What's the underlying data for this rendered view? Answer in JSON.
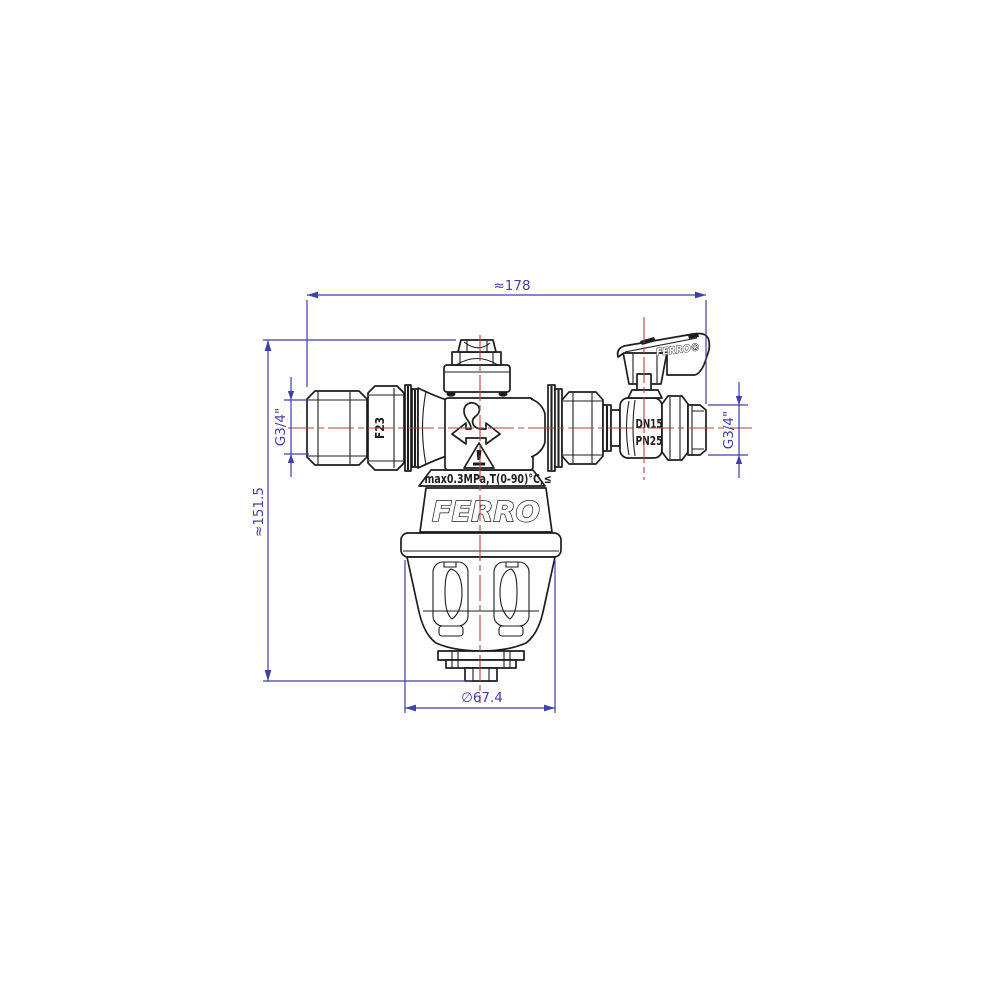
{
  "drawing": {
    "title": "FERRO magnetic filter with ball valve - technical drawing",
    "colors": {
      "background": "#ffffff",
      "outline": "#1d1d1d",
      "dimension": "#3f3fa8",
      "centerline": "#b6423c"
    },
    "dimensions": {
      "overall_width": "≈178",
      "overall_height": "≈151.5",
      "inlet_thread": "G3/4\"",
      "outlet_thread": "G3/4\"",
      "bowl_diameter": "∅67.4"
    },
    "markings": {
      "union_nut": "F23",
      "valve_size": "DN15",
      "valve_pressure": "PN25",
      "body_spec": "max0.3MPa,T(0-90)°C,≤",
      "body_brand": "FERRO",
      "handle_brand": "FERRO®"
    }
  }
}
